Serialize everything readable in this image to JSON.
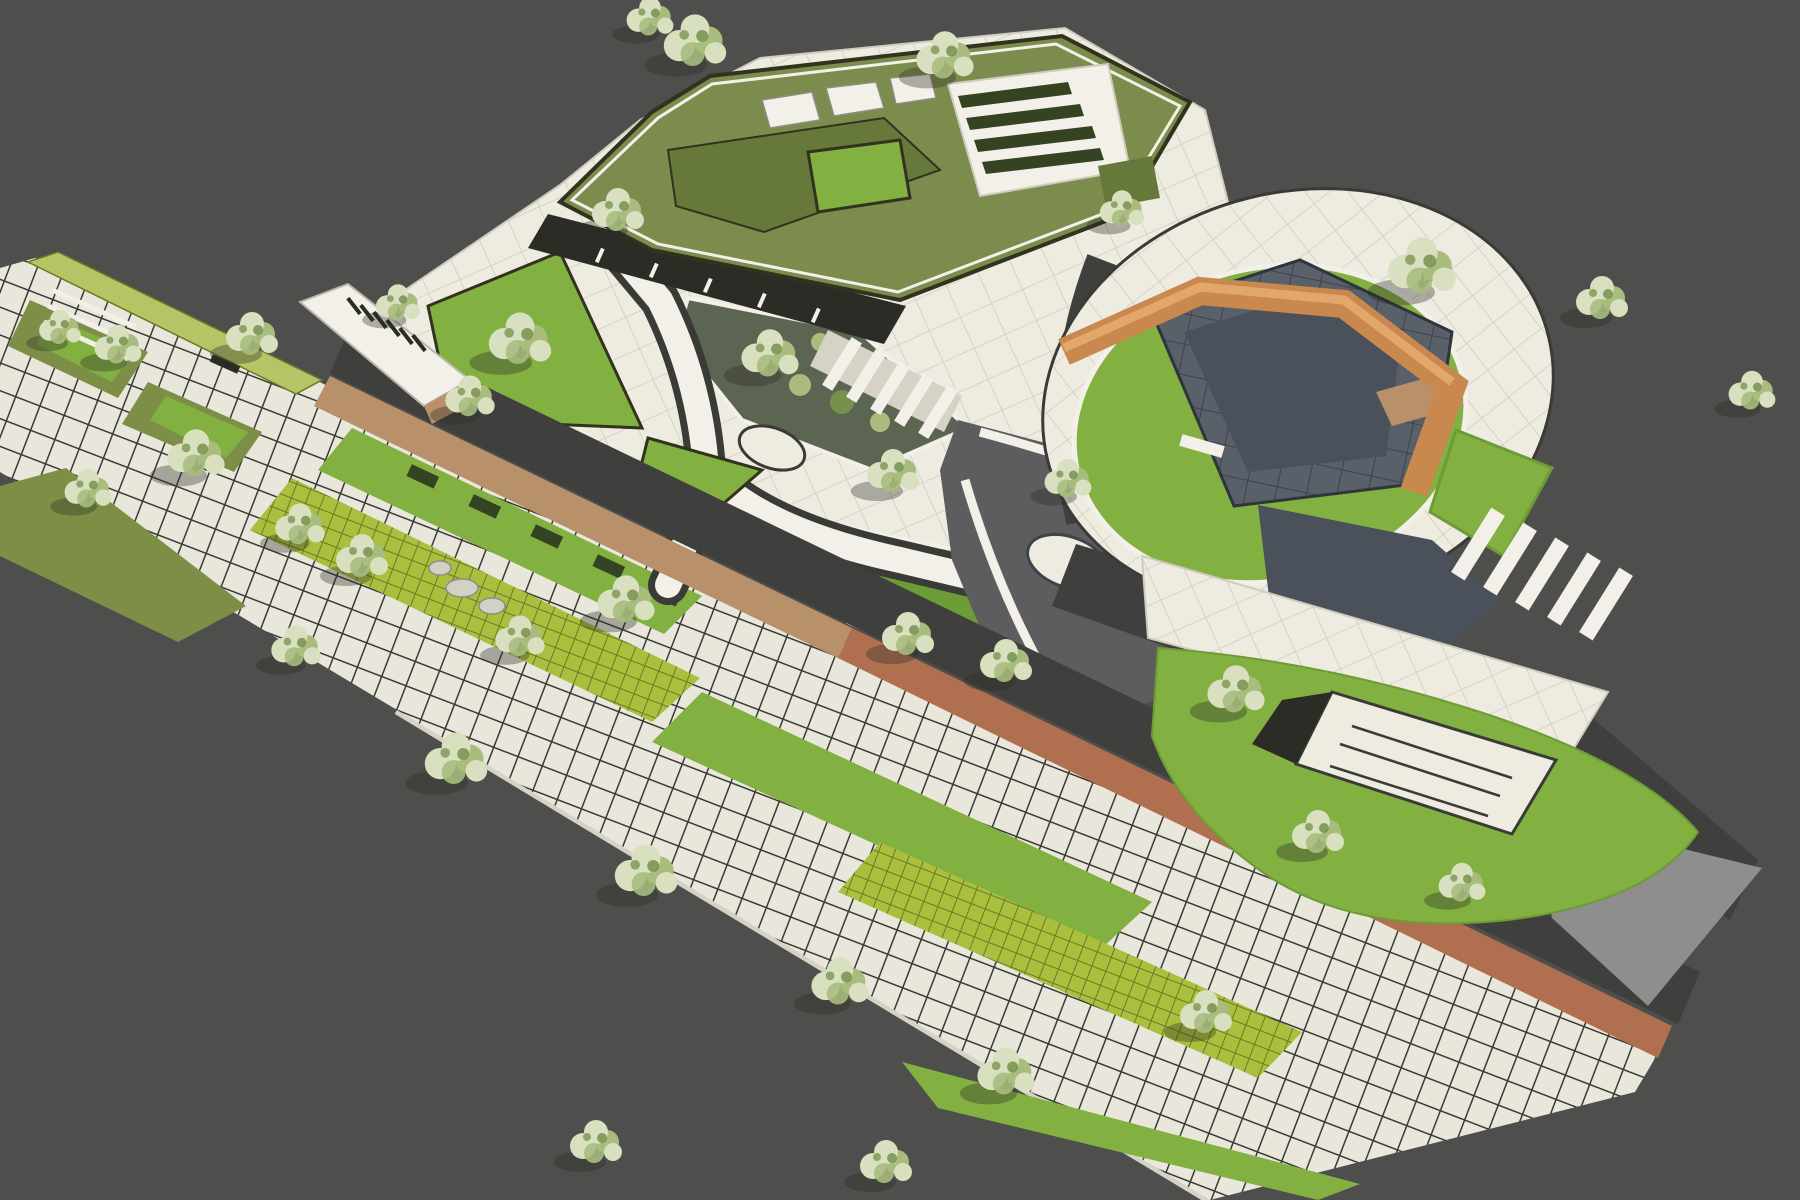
{
  "scene": {
    "description": "Stylized aerial 3D rendering of a landscape-architecture masterplan: a diagonal urban park with a green-roof building at top, a circular plaza with an angular copper pavilion at right, a white central plaza with Y-shaped paths and planting beds, a linear promenade at left, and a large gridded paver esplanade with lawn strips and trees across the bottom.",
    "view": "oblique aerial",
    "render_style": "illustrative architectural visualization, no text or UI elements visible"
  },
  "palette": {
    "background": "#4e4e4c",
    "paver": "#e9e7dc",
    "paverJoint": "#3a3a36",
    "paverSide": "#d6d3c6",
    "plaza": "#eeebe1",
    "plazaJoint": "#cfccbf",
    "grassPaver": "#a9bf3e",
    "grassJoint": "#6b7a24",
    "lawn": "#82b041",
    "lawnDeep": "#6d9b36",
    "olive": "#7d8f46",
    "roofGreen": "#7b8c4c",
    "roofTerrace": "#66793a",
    "hedgeYellow": "#b6c465",
    "hedgeDark": "#344322",
    "bedCobble": "#5c6452",
    "road": "#3f3f3d",
    "roadMid": "#6f6f6c",
    "roadLight": "#8e8e8c",
    "plazaDark": "#5d5d5f",
    "stoneDark": "#59606a",
    "stoneDarker": "#4a515b",
    "stoneJoint": "#3d434c",
    "stoneEdge": "#2f353d",
    "wood": "#b8906a",
    "terracotta": "#b07050",
    "orange": "#c9884e",
    "orangeLight": "#e2a76b",
    "white": "#f2f0e8",
    "facade": "#2c2c27",
    "boulder": "#d3d1c6",
    "paleLeaf": "#d8e0bf",
    "midLeaf": "#a9bc7e",
    "deepLeaf": "#77904c",
    "branch": "#26261f",
    "shadow": "#2a2a26",
    "outline": "#32321f"
  },
  "regions": [
    "green-roof-building",
    "rooftop-courtyard",
    "rooftop-hedge-garden",
    "building-facade",
    "building-forecourt-plaza",
    "central-plaza",
    "y-path-junction",
    "tree-island",
    "upper-planting-bed",
    "lower-planting-bed",
    "lawn-triangle",
    "white-canopy",
    "linear-promenade",
    "hedge-band",
    "promenade-planters",
    "boardwalk",
    "service-road",
    "event-plaza",
    "grand-steps",
    "circular-plaza",
    "stone-pentagon",
    "copper-pavilion",
    "lawn-ring",
    "sunken-lawn-court",
    "crosswalk",
    "asphalt-apron",
    "terracotta-boardwalk",
    "paver-esplanade",
    "grass-paver-strips",
    "lawn-strips",
    "boulders",
    "trees"
  ],
  "trees": [
    [
      695,
      48,
      1.2
    ],
    [
      945,
      62,
      1.1
    ],
    [
      650,
      22,
      0.9
    ],
    [
      618,
      216,
      1.0
    ],
    [
      398,
      308,
      0.85
    ],
    [
      520,
      346,
      1.2
    ],
    [
      470,
      402,
      0.95
    ],
    [
      252,
      340,
      1.0
    ],
    [
      118,
      350,
      0.9
    ],
    [
      60,
      332,
      0.8
    ],
    [
      196,
      460,
      1.1
    ],
    [
      88,
      494,
      0.9
    ],
    [
      300,
      530,
      0.95
    ],
    [
      362,
      562,
      1.0
    ],
    [
      520,
      642,
      0.95
    ],
    [
      626,
      606,
      1.1
    ],
    [
      770,
      360,
      1.1
    ],
    [
      893,
      477,
      1.0
    ],
    [
      908,
      640,
      1.0
    ],
    [
      1006,
      667,
      1.0
    ],
    [
      1068,
      484,
      0.9
    ],
    [
      1122,
      214,
      0.85
    ],
    [
      1236,
      696,
      1.1
    ],
    [
      1422,
      274,
      1.3
    ],
    [
      1602,
      304,
      1.0
    ],
    [
      1752,
      396,
      0.9
    ],
    [
      1318,
      838,
      1.0
    ],
    [
      1462,
      888,
      0.9
    ],
    [
      456,
      766,
      1.2
    ],
    [
      646,
      878,
      1.2
    ],
    [
      840,
      988,
      1.1
    ],
    [
      1006,
      1078,
      1.1
    ],
    [
      1206,
      1018,
      1.0
    ],
    [
      596,
      1148,
      1.0
    ],
    [
      886,
      1168,
      1.0
    ],
    [
      296,
      652,
      0.95
    ]
  ]
}
